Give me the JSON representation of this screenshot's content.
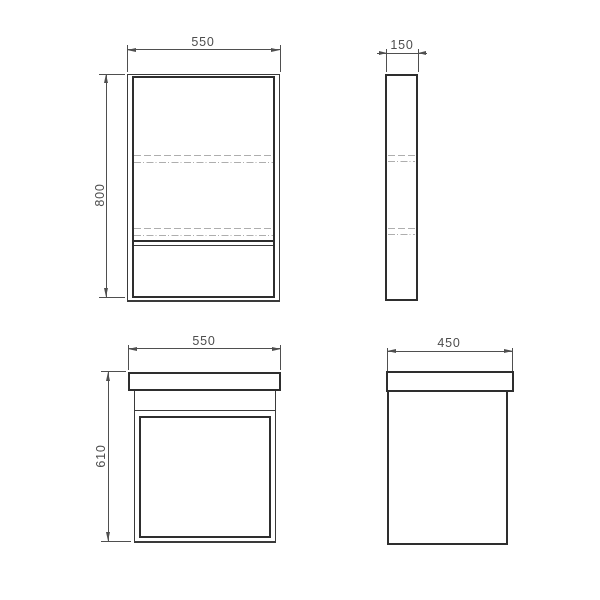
{
  "drawing": {
    "kind": "technical-drawing",
    "views": {
      "mirror_front": {
        "width": "550",
        "height": "800"
      },
      "mirror_side": {
        "depth": "150"
      },
      "vanity_front": {
        "width": "550",
        "height": "610"
      },
      "vanity_side": {
        "depth": "450"
      }
    },
    "dimensions": [
      {
        "id": "mirror-width",
        "value": "550"
      },
      {
        "id": "mirror-height",
        "value": "800"
      },
      {
        "id": "mirror-depth",
        "value": "150"
      },
      {
        "id": "vanity-width",
        "value": "550"
      },
      {
        "id": "vanity-height",
        "value": "610"
      },
      {
        "id": "vanity-depth",
        "value": "450"
      }
    ],
    "colors": {
      "outline": "#2e2e2e",
      "thin_outline": "#3a3a3a",
      "dimension_line": "#4f4f4f",
      "hidden_line": "#aeaeae",
      "label_text": "#4d4d4d",
      "background": "#ffffff"
    }
  }
}
